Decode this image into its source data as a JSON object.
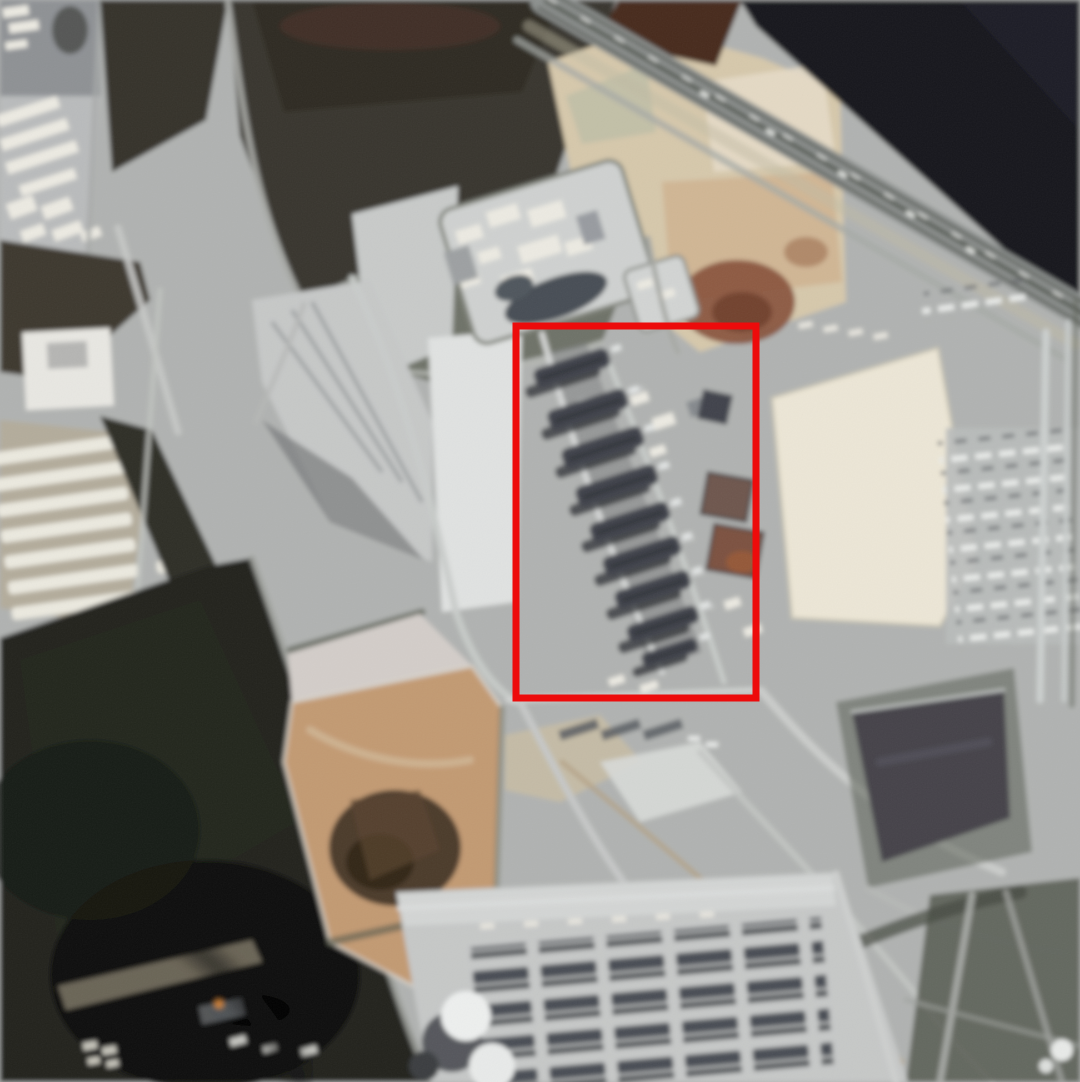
{
  "image": {
    "kind": "satellite-photograph",
    "width_px": 1080,
    "height_px": 1082,
    "description": "Overhead satellite photo of a desert industrial gas-plant complex: dark fields, sand pits, storage yards, a coastal highway with dark water beyond, two processing-train facilities, a dark settling pond, and a red rectangle annotation highlighting the diagonal row of processing trains in the central plant."
  },
  "annotation": {
    "shape": "rectangle",
    "color": "#ed0b0b",
    "x": 516,
    "y": 326,
    "width": 240,
    "height": 372,
    "stroke_width": 7
  },
  "palette": {
    "base_ground": "#b0b2b1",
    "dark_water": "#17181c",
    "dark_field": "#21221d",
    "olive_field": "#6e7267",
    "dark_olive_field": "#38362d",
    "sand": "#d6c8ab",
    "sand_pit": "#c29a72",
    "sand_pit_dark": "#4c3a2a",
    "cream_pad": "#ece6d6",
    "plant_light": "#c6c8c7",
    "bright_pad": "#e0e2e1",
    "train_dark": "#3f434b",
    "pond": "#45424a",
    "rust_patch": "#86503a",
    "highway": "#8c908e",
    "road_light": "#d2d4d3",
    "flare_orange": "#d08035"
  }
}
